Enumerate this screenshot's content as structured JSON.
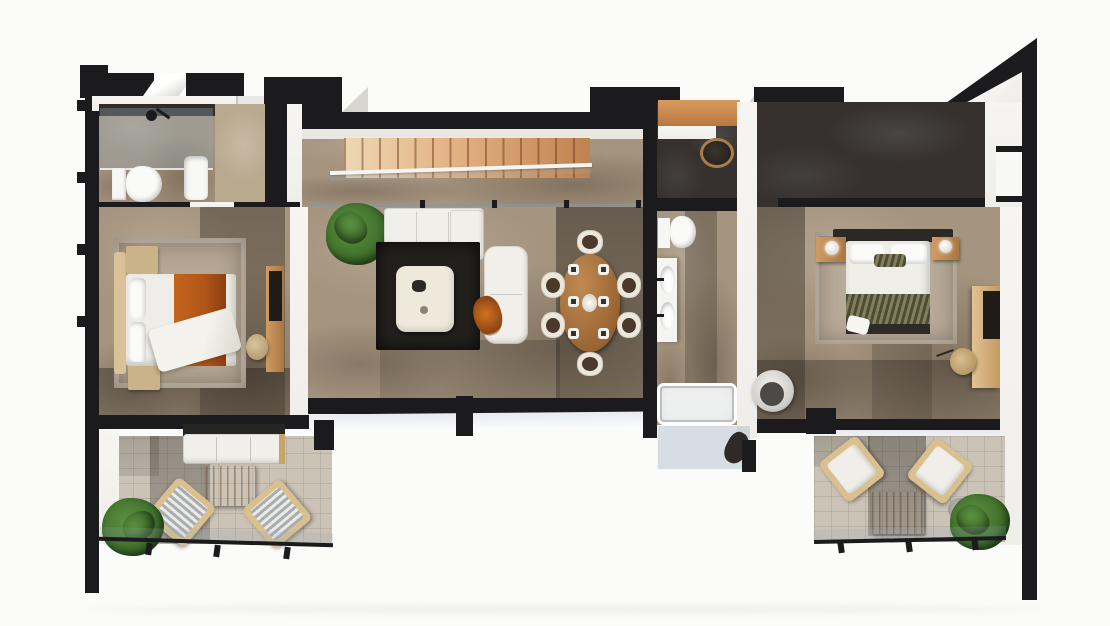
{
  "title": "Top-down 3D architectural floor-plan rendering of an apartment",
  "palette": {
    "bg": "#fbfbfa",
    "ink": "#1b1b1d",
    "wall_white": "#f0eeea",
    "wall_shade": "#d8d5cf",
    "floor": "#a5947e",
    "hall": "#36312e",
    "terrace": "#cac3b6",
    "rug_dark": "#221f1c",
    "rug_light": "#b5a794",
    "orange_throw": "#b05518",
    "olive_blanket": "#6d6a4e",
    "fire_glow": "#e64a16",
    "stair_light": "#eed7b4",
    "stair_dark": "#c0824f",
    "wood": "#c2905a",
    "plant_green": "#4a7a36"
  },
  "scene": {
    "view": "top-down cutaway render, black cut walls, white background",
    "rooms": [
      {
        "name": "bathroom-left",
        "furniture": [
          "walk-in-shower",
          "toilet",
          "washbasin"
        ]
      },
      {
        "name": "bedroom-left",
        "furniture": [
          "double-bed-orange-throw",
          "headboard",
          "two-nightstands",
          "area-rug",
          "desk-with-tv",
          "round-chair"
        ]
      },
      {
        "name": "entry-hall",
        "furniture": [
          "wardrobe",
          "entry-door"
        ]
      },
      {
        "name": "stair-hall",
        "furniture": [
          "wooden-staircase",
          "glass-balustrade"
        ]
      },
      {
        "name": "living-room",
        "furniture": [
          "white-sofa",
          "chaise-sofa",
          "dark-rug",
          "cream-coffee-table",
          "oval-dining-table",
          "six-dining-chairs",
          "plant",
          "fireplace-tv-panel"
        ]
      },
      {
        "name": "office-nook",
        "furniture": [
          "wood-desk-counter",
          "round-chair"
        ]
      },
      {
        "name": "bathroom-main",
        "furniture": [
          "toilet",
          "double-washbasin-vanity",
          "bathtub",
          "glass-shower"
        ]
      },
      {
        "name": "bedroom-main",
        "furniture": [
          "double-bed-olive-blanket",
          "two-nightstands-with-lamps",
          "area-rug",
          "desk-with-tv",
          "round-chair",
          "lounge-chair"
        ]
      },
      {
        "name": "terrace-left",
        "furniture": [
          "outdoor-sofa",
          "slatted-coffee-table",
          "two-striped-armchairs",
          "potted-plant",
          "glass-railing"
        ]
      },
      {
        "name": "terrace-right",
        "furniture": [
          "two-armchairs",
          "slatted-coffee-table",
          "potted-plant",
          "glass-railing"
        ]
      }
    ]
  }
}
